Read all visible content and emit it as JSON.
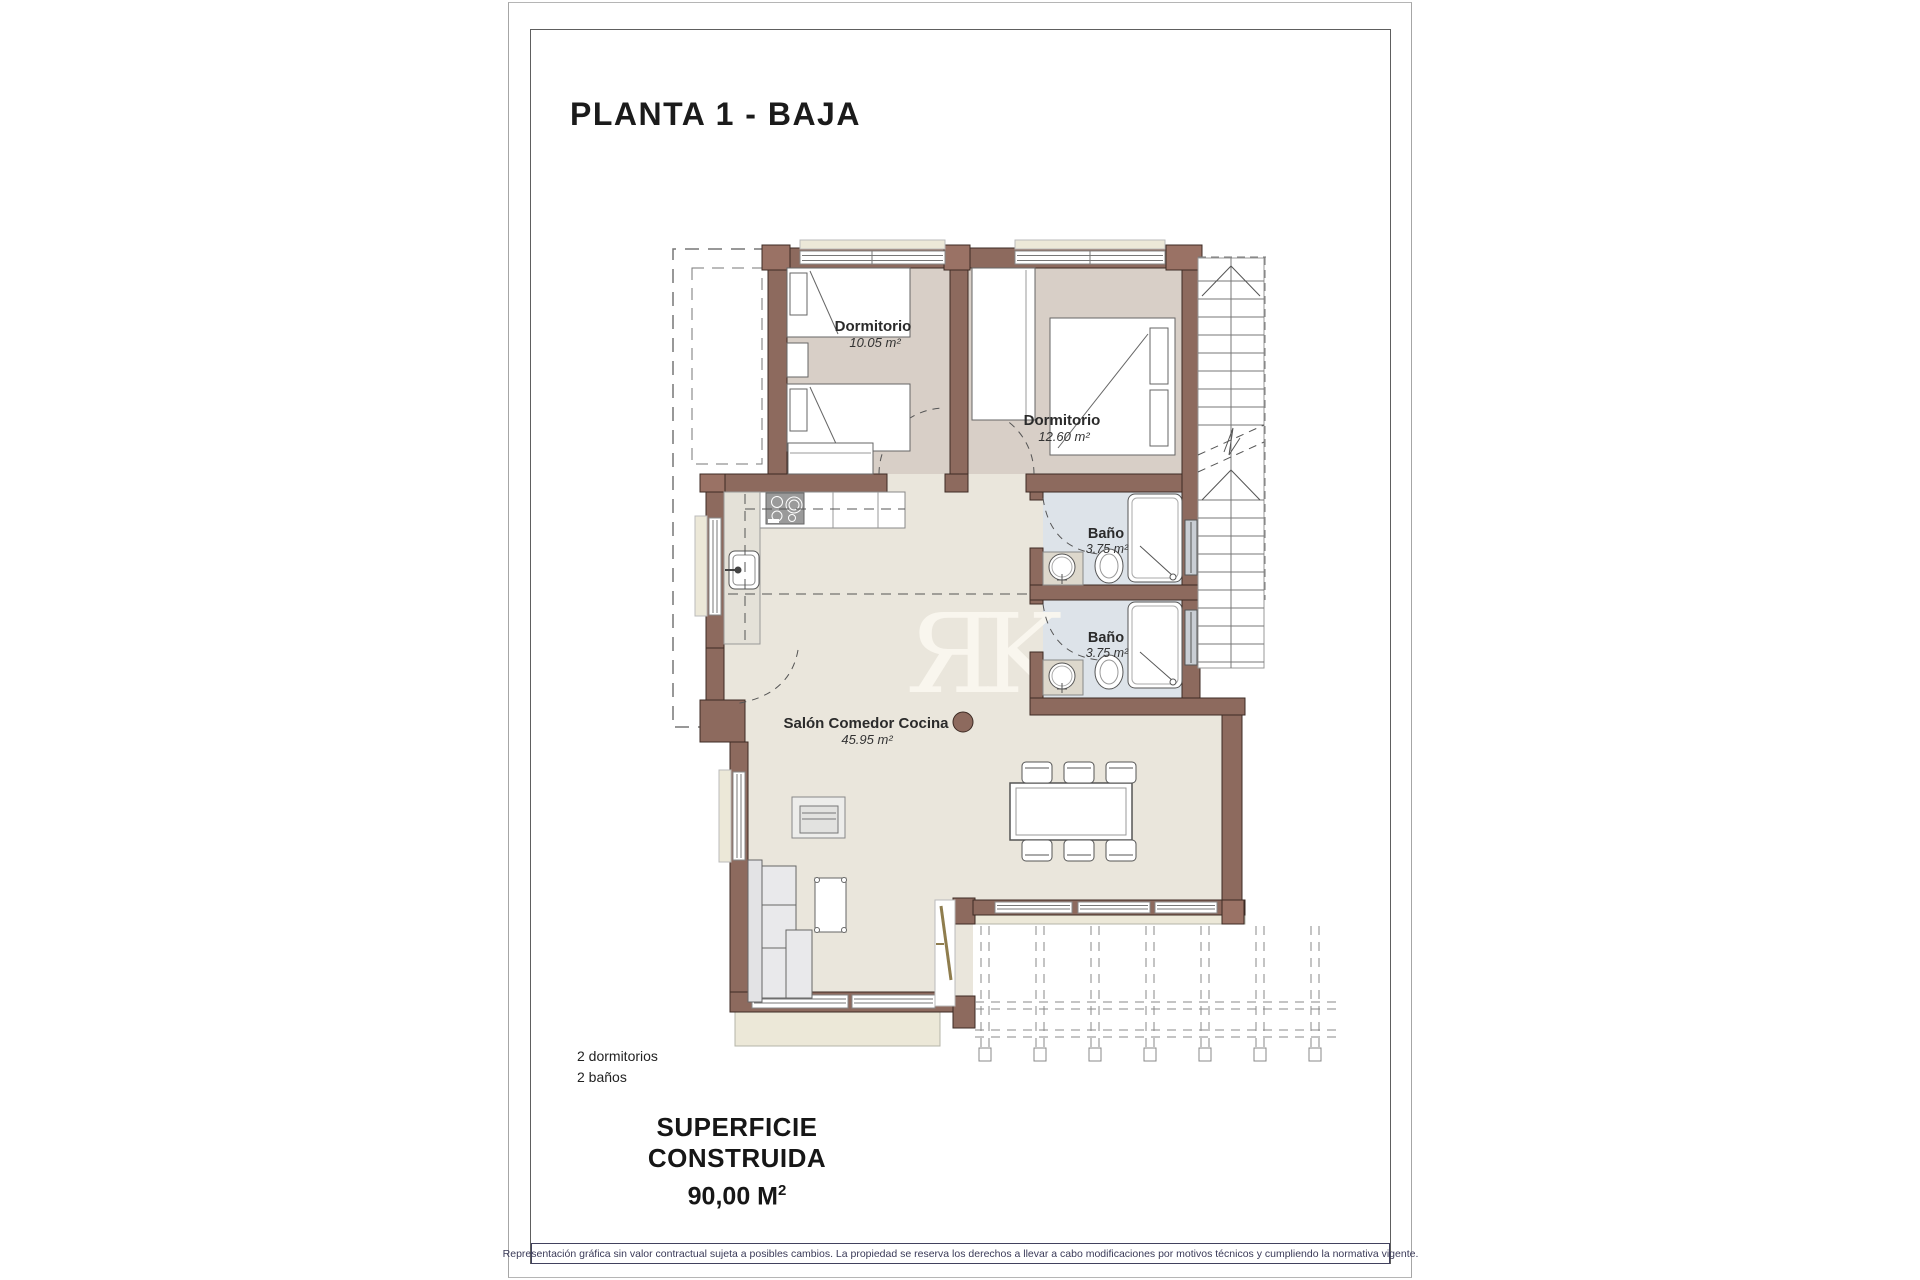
{
  "page": {
    "title": "PLANTA 1 - BAJA",
    "summary": {
      "bedrooms": "2 dormitorios",
      "bathrooms": "2 baños"
    },
    "built_area": {
      "label": "SUPERFICIE CONSTRUIDA",
      "value_main": "90,00 M",
      "value_sup": "2"
    },
    "disclaimer": "Representación gráfica sin valor contractual sujeta a posibles cambios. La propiedad se reserva los derechos a llevar a cabo modificaciones por motivos técnicos y cumpliendo la normativa vigente.",
    "watermark": "ЯK"
  },
  "plan": {
    "rooms": [
      {
        "name": "Dormitorio",
        "area": "10.05 m²"
      },
      {
        "name": "Dormitorio",
        "area": "12.60 m²"
      },
      {
        "name": "Baño",
        "area": "3.75 m²"
      },
      {
        "name": "Baño",
        "area": "3.75 m²"
      },
      {
        "name": "Salón Comedor Cocina",
        "area": "45.95 m²"
      }
    ],
    "colors": {
      "wall": "#8d6a5e",
      "wall_corner": "#9a7265",
      "bedroom_floor": "#d8cfc7",
      "living_floor": "#eae6dc",
      "bath_floor": "#dde3e9",
      "terrace": "#ece8d8",
      "disclaimer_text": "#3a3a58"
    }
  }
}
